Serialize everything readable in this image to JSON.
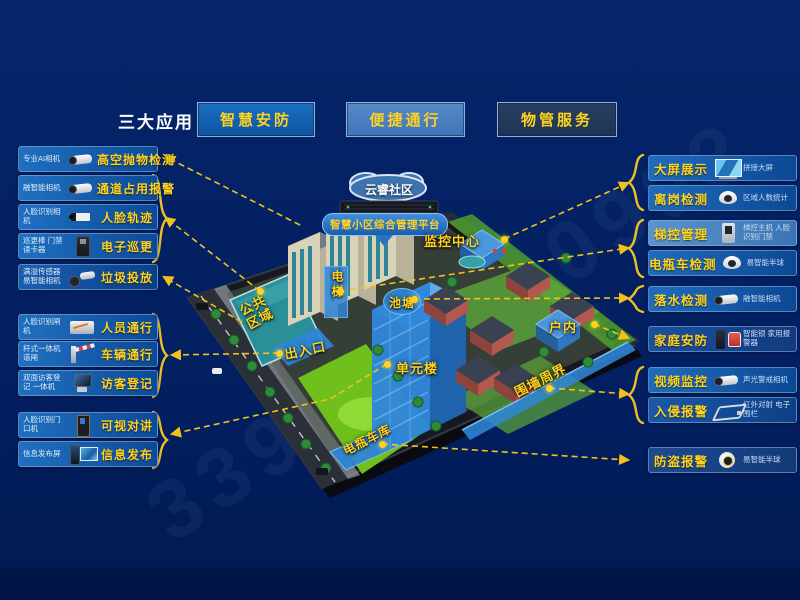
{
  "header": {
    "section_label": "三大应用",
    "tabs": [
      {
        "label": "智慧安防"
      },
      {
        "label": "便捷通行"
      },
      {
        "label": "物管服务"
      }
    ]
  },
  "left_panels": {
    "items": [
      {
        "device": "专业AI相机",
        "label": "高空抛物检测"
      },
      {
        "device": "融智能相机",
        "label": "通道占用报警"
      },
      {
        "device": "人脸识别相机",
        "label": "人脸轨迹"
      },
      {
        "device": "巡更棒 门禁读卡器",
        "label": "电子巡更"
      },
      {
        "device": "满溢传感器 易智能相机",
        "label": "垃圾投放"
      },
      {
        "device": "人脸识别闸机",
        "label": "人员通行"
      },
      {
        "device": "杆式一体机 道闸",
        "label": "车辆通行"
      },
      {
        "device": "双面访客登记 一体机",
        "label": "访客登记"
      },
      {
        "device": "人脸识别门口机",
        "label": "可视对讲"
      },
      {
        "device": "信息发布屏",
        "label": "信息发布"
      }
    ]
  },
  "right_panels": {
    "items": [
      {
        "label": "大屏展示",
        "device": "拼接大屏"
      },
      {
        "label": "离岗检测",
        "device": "区域人数统计"
      },
      {
        "label": "梯控管理",
        "device": "梯控主机 人脸识别门禁"
      },
      {
        "label": "电瓶车检测",
        "device": "易智能半球"
      },
      {
        "label": "落水检测",
        "device": "融智能相机"
      },
      {
        "label": "家庭安防",
        "device": "智能锁 家用报警器"
      },
      {
        "label": "视频监控",
        "device": "声光警戒相机"
      },
      {
        "label": "入侵报警",
        "device": "红外对射 电子围栏"
      },
      {
        "label": "防盗报警",
        "device": "易智能半球"
      }
    ]
  },
  "map": {
    "cloud": "云睿社区",
    "platform": "智慧小区综合管理平台",
    "monitor_center": "监控中心",
    "elevator": "电梯",
    "pond": "池塘",
    "public_area": "公共区域",
    "entrance": "出入口",
    "unit_building": "单元楼",
    "indoor": "户内",
    "perimeter": "围墙周界",
    "ebike_garage": "电瓶车库"
  },
  "watermark": "339-6202-0902",
  "colors": {
    "background": "#042162",
    "accent_yellow": "#ffd21f",
    "panel_blue": "#1b66b4",
    "highlight_blue": "#2f86d8"
  }
}
